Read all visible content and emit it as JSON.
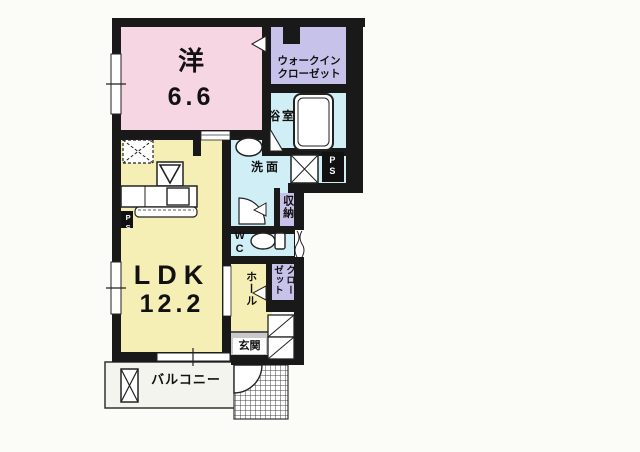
{
  "plan": {
    "western_room": {
      "label": "洋",
      "size": "6.6"
    },
    "walk_in_closet": {
      "line1": "ウォークイン",
      "line2": "クローゼット"
    },
    "bathroom": {
      "label": "浴室"
    },
    "washroom": {
      "label": "洗面"
    },
    "pipe_space_right": {
      "label": "PS"
    },
    "pipe_space_left": {
      "label": "PS"
    },
    "storage": {
      "label": "収納"
    },
    "wc": {
      "label": "WC"
    },
    "hall": {
      "label": "ホール"
    },
    "closet": {
      "label": "クローゼット"
    },
    "entrance": {
      "label": "玄関"
    },
    "ldk": {
      "label": "LDK",
      "size": "12.2"
    },
    "balcony": {
      "label": "バルコニー"
    }
  },
  "colors": {
    "wall": "#191919",
    "western_room": "#f6d6e3",
    "ldk": "#f5efb5",
    "hall": "#f5efb5",
    "wet_area": "#d0eef5",
    "closet": "#c6c2e9",
    "entrance": "#c9c9c9",
    "balcony": "#f4f4ee",
    "fixture": "#ffffff"
  }
}
